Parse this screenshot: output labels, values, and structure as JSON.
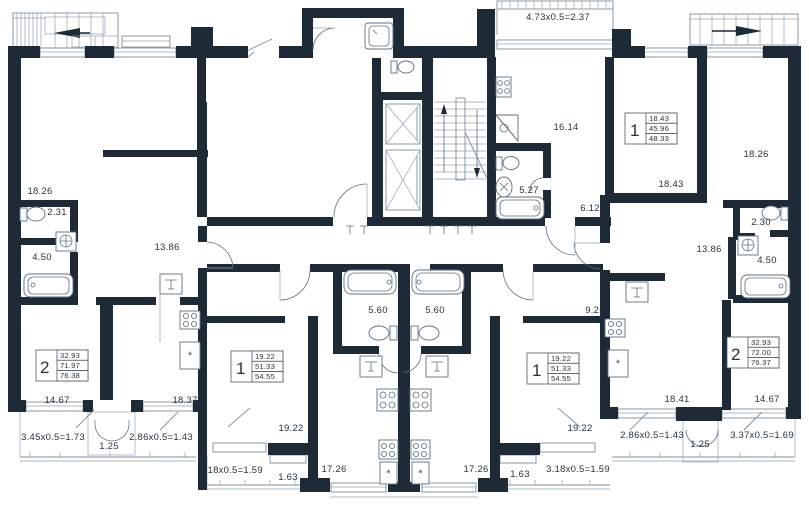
{
  "drawing": {
    "type": "residential-floor-plan"
  },
  "colors": {
    "wall": "#1e2a36",
    "line": "#7e90a0",
    "text": "#26333f",
    "bg": "#ffffff"
  },
  "icons": {
    "fridge": "*",
    "sink": "⊤"
  },
  "labels": [
    {
      "name": "room-18-26-left",
      "text": "18.26",
      "x": 40,
      "y": 194
    },
    {
      "name": "room-2-31",
      "text": "2.31",
      "x": 57,
      "y": 215
    },
    {
      "name": "room-4-50-left",
      "text": "4.50",
      "x": 42,
      "y": 260
    },
    {
      "name": "room-13-86-left",
      "text": "13.86",
      "x": 167,
      "y": 250
    },
    {
      "name": "room-14-67-left",
      "text": "14.67",
      "x": 57,
      "y": 403
    },
    {
      "name": "room-18-37",
      "text": "18.37",
      "x": 185,
      "y": 403
    },
    {
      "name": "dim-3-45",
      "text": "3.45x0.5=1.73",
      "x": 53,
      "y": 440
    },
    {
      "name": "dim-1-25-left",
      "text": "1.25",
      "x": 109,
      "y": 449
    },
    {
      "name": "dim-2-86-left",
      "text": "2.86x0.5=1.43",
      "x": 161,
      "y": 440
    },
    {
      "name": "dim-3-18-left",
      "text": "3.18x0.5=1.59",
      "x": 231,
      "y": 473
    },
    {
      "name": "dim-1-63-left",
      "text": "1.63",
      "x": 288,
      "y": 480
    },
    {
      "name": "room-19-22-left",
      "text": "19.22",
      "x": 291,
      "y": 431
    },
    {
      "name": "room-17-26-left",
      "text": "17.26",
      "x": 334,
      "y": 472
    },
    {
      "name": "room-5-60-left",
      "text": "5.60",
      "x": 378,
      "y": 313
    },
    {
      "name": "room-5-60-right",
      "text": "5.60",
      "x": 435,
      "y": 313
    },
    {
      "name": "room-17-26-right",
      "text": "17.26",
      "x": 476,
      "y": 472
    },
    {
      "name": "dim-1-63-right",
      "text": "1.63",
      "x": 520,
      "y": 477
    },
    {
      "name": "dim-3-18-right",
      "text": "3.18x0.5=1.59",
      "x": 578,
      "y": 472
    },
    {
      "name": "room-19-22-right",
      "text": "19.22",
      "x": 580,
      "y": 431
    },
    {
      "name": "room-9-25",
      "text": "9.25",
      "x": 595,
      "y": 313
    },
    {
      "name": "dim-4-73",
      "text": "4.73x0.5=2.37",
      "x": 558,
      "y": 20
    },
    {
      "name": "room-16-14",
      "text": "16.14",
      "x": 566,
      "y": 130
    },
    {
      "name": "room-5-27",
      "text": "5.27",
      "x": 529,
      "y": 193
    },
    {
      "name": "room-6-12",
      "text": "6.12",
      "x": 590,
      "y": 211
    },
    {
      "name": "room-18-43",
      "text": "18.43",
      "x": 671,
      "y": 187
    },
    {
      "name": "room-18-26-right",
      "text": "18.26",
      "x": 756,
      "y": 157
    },
    {
      "name": "room-2-30",
      "text": "2.30",
      "x": 761,
      "y": 225
    },
    {
      "name": "room-4-50-right",
      "text": "4.50",
      "x": 767,
      "y": 263
    },
    {
      "name": "room-13-86-right",
      "text": "13.86",
      "x": 709,
      "y": 252
    },
    {
      "name": "room-18-41",
      "text": "18.41",
      "x": 677,
      "y": 402
    },
    {
      "name": "room-14-67-right",
      "text": "14.67",
      "x": 767,
      "y": 402
    },
    {
      "name": "dim-2-86-right",
      "text": "2.86x0.5=1.43",
      "x": 652,
      "y": 438
    },
    {
      "name": "dim-1-25-right",
      "text": "1.25",
      "x": 700,
      "y": 447
    },
    {
      "name": "dim-3-37",
      "text": "3.37x0.5=1.69",
      "x": 762,
      "y": 438
    }
  ],
  "units": [
    {
      "name": "unit-2-left",
      "number": "2",
      "rows": [
        "32.93",
        "71.97",
        "76.38"
      ]
    },
    {
      "name": "unit-1-left-center",
      "number": "1",
      "rows": [
        "19.22",
        "51.33",
        "54.55"
      ]
    },
    {
      "name": "unit-1-right-center",
      "number": "1",
      "rows": [
        "19.22",
        "51.33",
        "54.55"
      ]
    },
    {
      "name": "unit-1-top-right",
      "number": "1",
      "rows": [
        "18.43",
        "45.96",
        "48.33"
      ]
    },
    {
      "name": "unit-2-right",
      "number": "2",
      "rows": [
        "32.93",
        "72.00",
        "76.37"
      ]
    }
  ]
}
